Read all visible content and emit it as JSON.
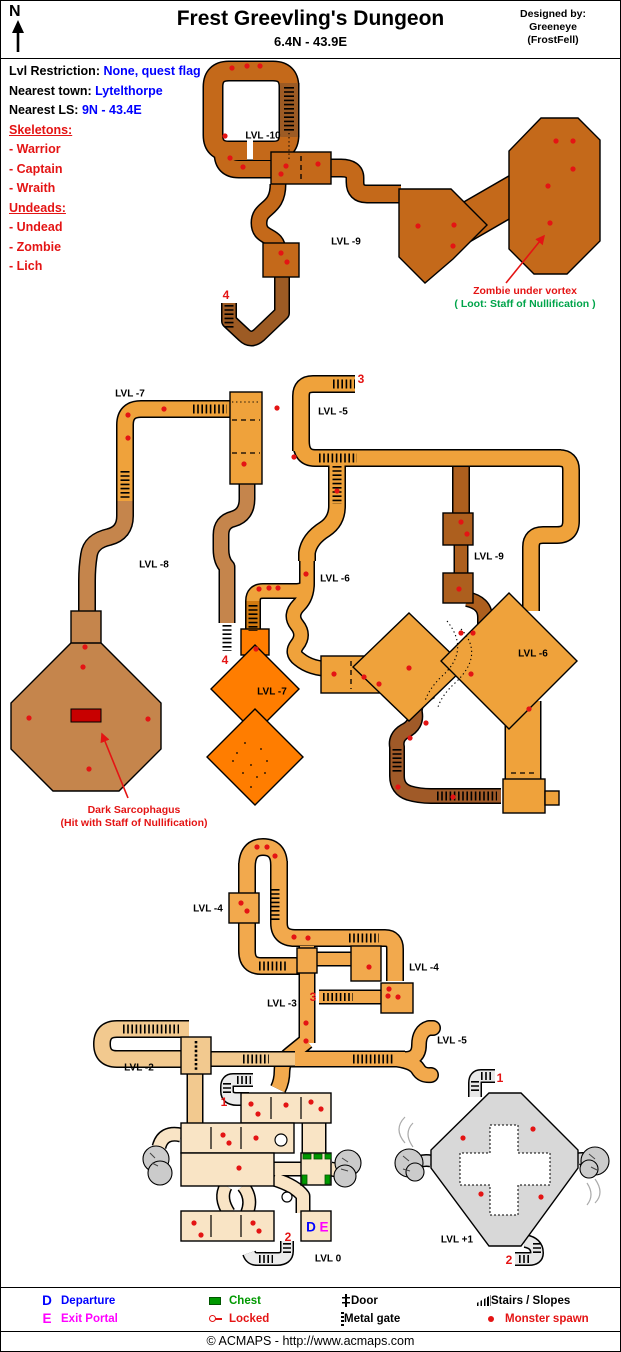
{
  "header": {
    "compass": "N",
    "title": "Frest Greevling's Dungeon",
    "subtitle": "6.4N - 43.9E",
    "designed_by_label": "Designed by:",
    "designer": "Greeneye",
    "designer_guild": "(FrostFell)"
  },
  "info": {
    "rows": [
      {
        "label": "Lvl Restriction:",
        "value": "None, quest flag"
      },
      {
        "label": "Nearest town:",
        "value": "Lytelthorpe"
      },
      {
        "label": "Nearest LS:",
        "value": "9N - 43.4E"
      }
    ],
    "groups": [
      {
        "title": "Skeletons:",
        "items": [
          "- Warrior",
          "- Captain",
          "- Wraith"
        ]
      },
      {
        "title": "Undeads:",
        "items": [
          "- Undead",
          "- Zombie",
          "- Lich"
        ]
      }
    ]
  },
  "map": {
    "spawn_color": "#e41414",
    "level_labels": [
      {
        "text": "LVL -10",
        "x": 262,
        "y": 135
      },
      {
        "text": "LVL -9",
        "x": 345,
        "y": 241
      },
      {
        "text": "LVL -7",
        "x": 129,
        "y": 393
      },
      {
        "text": "LVL -5",
        "x": 332,
        "y": 411
      },
      {
        "text": "LVL -8",
        "x": 153,
        "y": 564
      },
      {
        "text": "LVL -6",
        "x": 334,
        "y": 578
      },
      {
        "text": "LVL -9",
        "x": 488,
        "y": 556
      },
      {
        "text": "LVL -6",
        "x": 532,
        "y": 653
      },
      {
        "text": "LVL -7",
        "x": 271,
        "y": 691
      },
      {
        "text": "LVL -4",
        "x": 207,
        "y": 908
      },
      {
        "text": "LVL -4",
        "x": 423,
        "y": 967
      },
      {
        "text": "LVL -3",
        "x": 281,
        "y": 1003
      },
      {
        "text": "LVL -5",
        "x": 451,
        "y": 1040
      },
      {
        "text": "LVL -2",
        "x": 138,
        "y": 1067
      },
      {
        "text": "LVL 0",
        "x": 327,
        "y": 1258
      },
      {
        "text": "LVL +1",
        "x": 456,
        "y": 1239
      }
    ],
    "markers": [
      {
        "text": "4",
        "x": 225,
        "y": 294
      },
      {
        "text": "3",
        "x": 360,
        "y": 378
      },
      {
        "text": "4",
        "x": 224,
        "y": 659
      },
      {
        "text": "3",
        "x": 312,
        "y": 996
      },
      {
        "text": "1",
        "x": 223,
        "y": 1101
      },
      {
        "text": "2",
        "x": 287,
        "y": 1236
      },
      {
        "text": "1",
        "x": 499,
        "y": 1077
      },
      {
        "text": "2",
        "x": 508,
        "y": 1259
      }
    ],
    "portals": [
      {
        "text": "D",
        "x": 310,
        "y": 1226,
        "color": "#0000ff"
      },
      {
        "text": "E",
        "x": 323,
        "y": 1226,
        "color": "#ff00ff"
      }
    ],
    "annotations": [
      {
        "x": 524,
        "y": 284,
        "lines": [
          {
            "text": "Zombie under vortex",
            "color": "#e41414"
          },
          {
            "text": "( Loot: Staff of Nullification )",
            "color": "#00a44a"
          }
        ]
      },
      {
        "x": 133,
        "y": 803,
        "lines": [
          {
            "text": "Dark Sarcophagus",
            "color": "#e41414"
          },
          {
            "text": "(Hit with Staff of Nullification)",
            "color": "#e41414"
          }
        ]
      }
    ],
    "spawns": [
      [
        231,
        67
      ],
      [
        246,
        65
      ],
      [
        259,
        65
      ],
      [
        224,
        135
      ],
      [
        229,
        157
      ],
      [
        242,
        166
      ],
      [
        285,
        165
      ],
      [
        280,
        173
      ],
      [
        317,
        163
      ],
      [
        417,
        225
      ],
      [
        453,
        224
      ],
      [
        452,
        245
      ],
      [
        555,
        140
      ],
      [
        572,
        140
      ],
      [
        572,
        168
      ],
      [
        547,
        185
      ],
      [
        549,
        222
      ],
      [
        280,
        252
      ],
      [
        286,
        261
      ],
      [
        163,
        408
      ],
      [
        276,
        407
      ],
      [
        127,
        414
      ],
      [
        127,
        437
      ],
      [
        243,
        463
      ],
      [
        293,
        456
      ],
      [
        336,
        490
      ],
      [
        305,
        573
      ],
      [
        277,
        587
      ],
      [
        268,
        587
      ],
      [
        258,
        588
      ],
      [
        255,
        648
      ],
      [
        460,
        521
      ],
      [
        466,
        533
      ],
      [
        458,
        588
      ],
      [
        84,
        646
      ],
      [
        82,
        666
      ],
      [
        28,
        717
      ],
      [
        147,
        718
      ],
      [
        88,
        768
      ],
      [
        460,
        632
      ],
      [
        472,
        632
      ],
      [
        470,
        673
      ],
      [
        408,
        667
      ],
      [
        528,
        708
      ],
      [
        333,
        673
      ],
      [
        363,
        676
      ],
      [
        378,
        683
      ],
      [
        425,
        722
      ],
      [
        409,
        737
      ],
      [
        397,
        786
      ],
      [
        452,
        796
      ],
      [
        256,
        846
      ],
      [
        266,
        846
      ],
      [
        274,
        855
      ],
      [
        240,
        902
      ],
      [
        246,
        910
      ],
      [
        293,
        936
      ],
      [
        307,
        937
      ],
      [
        368,
        966
      ],
      [
        388,
        988
      ],
      [
        387,
        995
      ],
      [
        397,
        996
      ],
      [
        305,
        1022
      ],
      [
        305,
        1040
      ],
      [
        250,
        1103
      ],
      [
        257,
        1113
      ],
      [
        285,
        1104
      ],
      [
        310,
        1101
      ],
      [
        320,
        1108
      ],
      [
        222,
        1134
      ],
      [
        228,
        1142
      ],
      [
        255,
        1137
      ],
      [
        238,
        1167
      ],
      [
        193,
        1222
      ],
      [
        200,
        1234
      ],
      [
        252,
        1222
      ],
      [
        258,
        1230
      ],
      [
        462,
        1137
      ],
      [
        532,
        1128
      ],
      [
        480,
        1193
      ],
      [
        540,
        1196
      ]
    ]
  },
  "legend": {
    "columns": [
      [
        {
          "icon": "departure-d",
          "sym": "D",
          "label": "Departure",
          "color": "#0000ff"
        },
        {
          "icon": "exit-e",
          "sym": "E",
          "label": "Exit Portal",
          "color": "#ff00ff"
        }
      ],
      [
        {
          "icon": "chest",
          "label": "Chest",
          "color": "#009900"
        },
        {
          "icon": "locked-key",
          "label": "Locked",
          "color": "#e41414"
        }
      ],
      [
        {
          "icon": "door",
          "label": "Door",
          "color": "#000000"
        },
        {
          "icon": "metal-gate",
          "label": "Metal gate",
          "color": "#000000"
        }
      ],
      [
        {
          "icon": "stairs",
          "label": "Stairs / Slopes",
          "color": "#000000"
        },
        {
          "icon": "monster-spawn",
          "label": "Monster spawn",
          "color": "#e41414"
        }
      ]
    ]
  },
  "footer": {
    "copyright": "© ACMAPS - http://www.acmaps.com"
  }
}
